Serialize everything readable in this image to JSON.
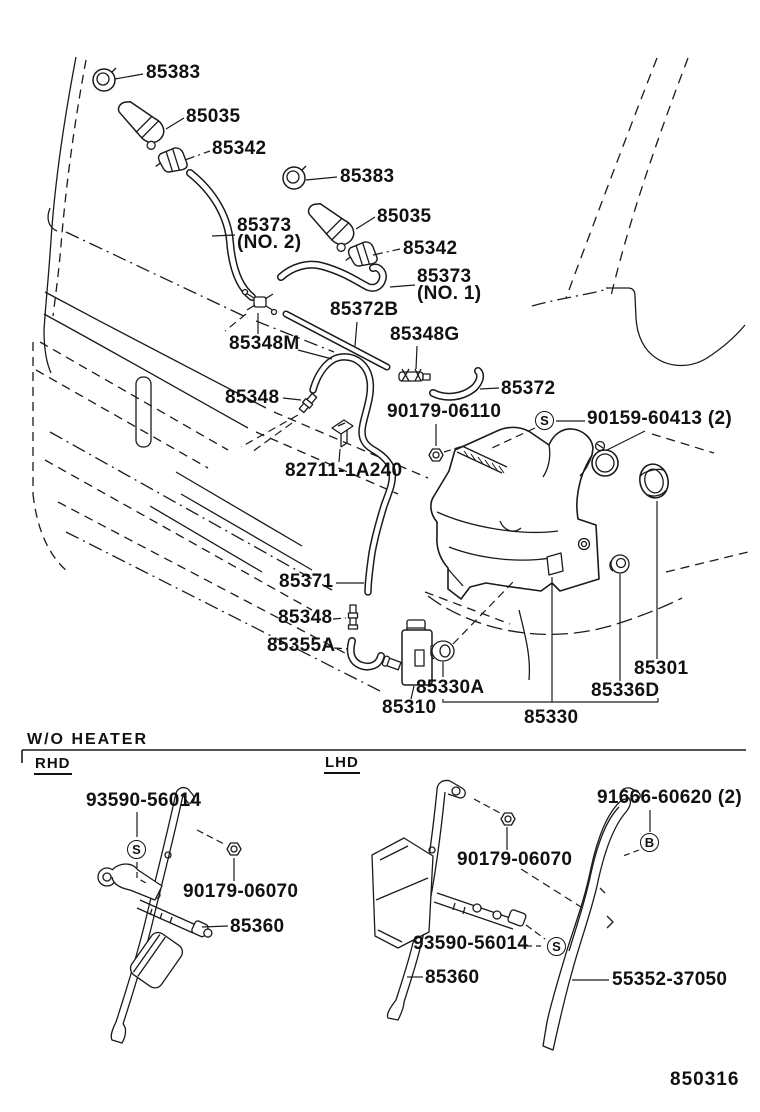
{
  "page": {
    "bg": "#ffffff",
    "ink": "#1a1a1a"
  },
  "diagram": {
    "figure_number": "850316",
    "section_header": "W/O  HEATER",
    "variant_left": "RHD",
    "variant_right": "LHD",
    "marker_s": "S",
    "marker_b": "B",
    "parts": {
      "p85383": "85383",
      "p85035": "85035",
      "p85342": "85342",
      "p85373": "85373",
      "no1": "(NO. 1)",
      "no2": "(NO. 2)",
      "p85372b": "85372B",
      "p85348m": "85348M",
      "p85348g": "85348G",
      "p85372": "85372",
      "p85348": "85348",
      "p90179_06110": "90179-06110",
      "p90159_60413": "90159-60413 (2)",
      "p82711_1a240": "82711-1A240",
      "p85371": "85371",
      "p85355a": "85355A",
      "p85330a": "85330A",
      "p85310": "85310",
      "p85330": "85330",
      "p85336d": "85336D",
      "p85301": "85301",
      "p93590_56014": "93590-56014",
      "p90179_06070": "90179-06070",
      "p85360": "85360",
      "p91666_60620": "91666-60620 (2)",
      "p55352_37050": "55352-37050"
    }
  }
}
